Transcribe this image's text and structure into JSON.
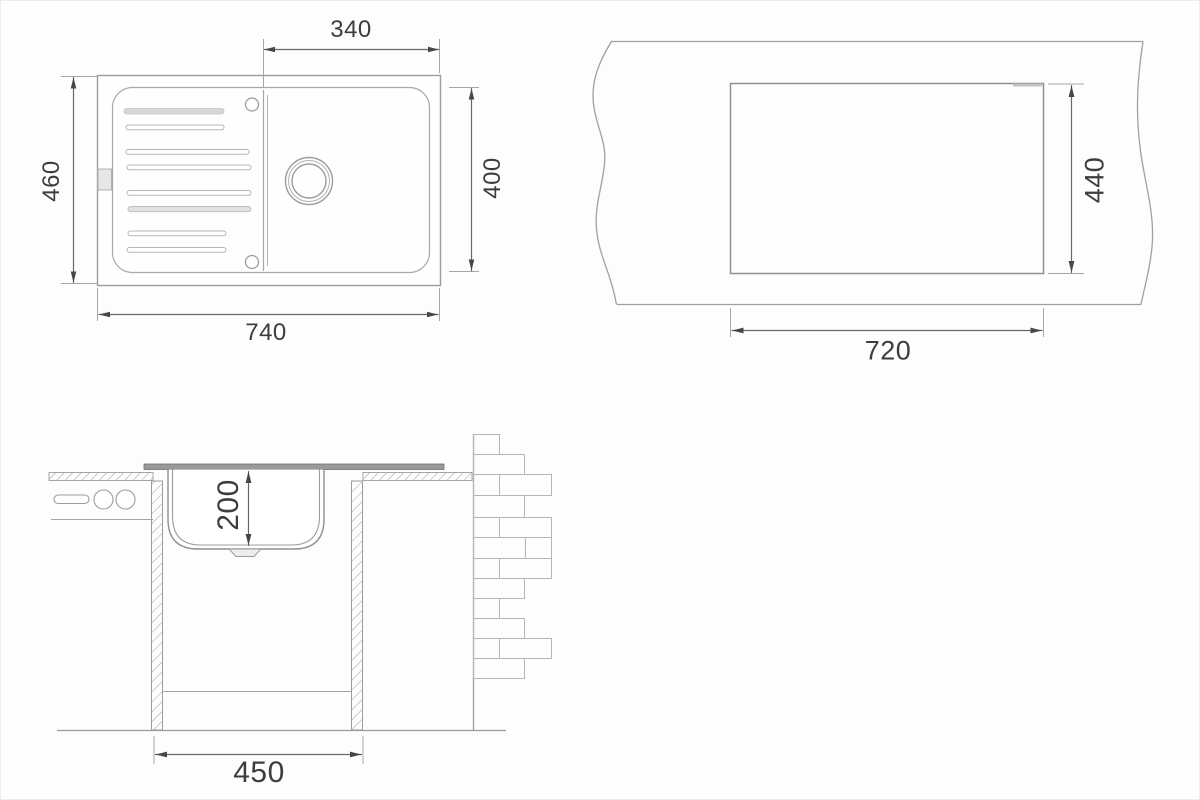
{
  "drawing": {
    "title": "sink-installation-drawing",
    "views": {
      "top_view": {
        "name": "sink-top-view",
        "dims": {
          "bowl_width": "340",
          "overall_depth": "460",
          "bowl_depth": "400",
          "overall_width": "740"
        }
      },
      "cutout_view": {
        "name": "countertop-cutout-view",
        "dims": {
          "cutout_height": "440",
          "cutout_width": "720"
        }
      },
      "section_view": {
        "name": "cabinet-section-view",
        "dims": {
          "bowl_height": "200",
          "cabinet_width": "450"
        }
      }
    },
    "colors": {
      "outline": "#9b9b9b",
      "dim_line": "#686868",
      "arrow": "#474747",
      "text": "#3d3d3d",
      "rim_fill": "#999999",
      "ridge_fill": "#d7d7d7"
    }
  }
}
